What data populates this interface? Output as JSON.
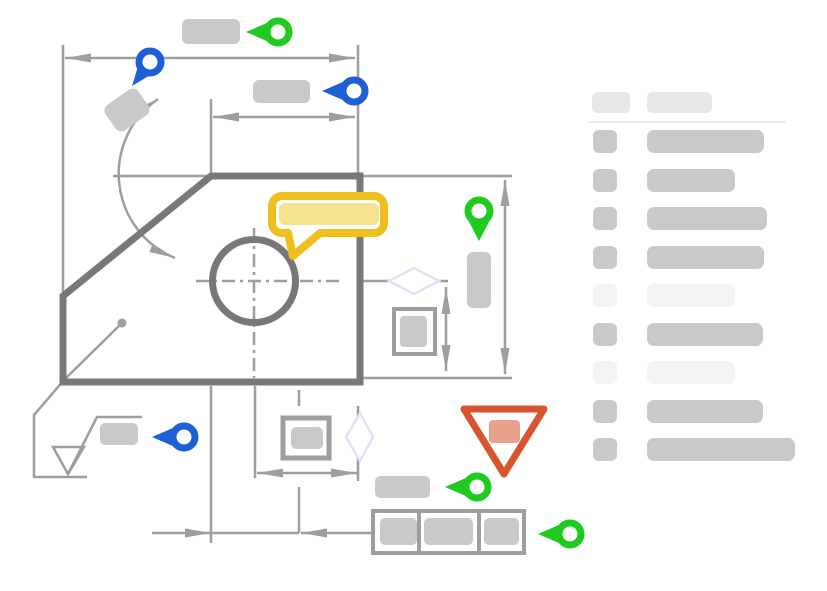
{
  "canvas": {
    "width": 827,
    "height": 591,
    "background": "#FFFFFF"
  },
  "colors": {
    "accent_green": "#1FCB1F",
    "accent_blue": "#1E5FD6",
    "comment_yellow": "#EFBF1D",
    "comment_yellow_fill": "#F5E28F",
    "warning_red": "#D6552F",
    "warning_red_fill": "#EAA28F",
    "outline_dark": "#787878",
    "line_gray": "#9E9E9E",
    "snap_diamond": "#DBE5F8",
    "placeholder_gray": "#C9C9C9",
    "placeholder_faint": "#F3F3F3",
    "placeholder_header": "#E8E8E8",
    "divider": "#ECECEC"
  },
  "drawing": {
    "annotations": [
      {
        "name": "top-overall-dimension",
        "marker": "green-pin-left",
        "label": "placeholder-bar"
      },
      {
        "name": "top-left-dimension",
        "marker": "blue-pin-tilted",
        "label": "placeholder-square-rotated"
      },
      {
        "name": "top-partial-dimension",
        "marker": "blue-pin-left",
        "label": "placeholder-bar"
      },
      {
        "name": "angle-dimension-arc",
        "marker": null,
        "label": null
      },
      {
        "name": "right-height-dimension",
        "marker": "green-map-pin",
        "label": "placeholder-bar-vertical"
      },
      {
        "name": "comment-bubble",
        "marker": "yellow-speech-bubble",
        "label": "placeholder-bar"
      },
      {
        "name": "surface-finish-callout",
        "marker": "blue-pin-left",
        "label": "placeholder-bar"
      },
      {
        "name": "warning-marker",
        "marker": "red-inverted-triangle",
        "label": "placeholder-square"
      },
      {
        "name": "tolerance-label",
        "marker": "green-pin-left",
        "label": "placeholder-bar"
      },
      {
        "name": "feature-control-frame",
        "marker": "green-pin-left",
        "cells": 3
      }
    ]
  },
  "sidebar": {
    "header": {
      "badge_w": 38,
      "title_w": 65
    },
    "rows": [
      {
        "tone": "normal",
        "bar_w": 117
      },
      {
        "tone": "normal",
        "bar_w": 88
      },
      {
        "tone": "normal",
        "bar_w": 120
      },
      {
        "tone": "normal",
        "bar_w": 117
      },
      {
        "tone": "faint",
        "bar_w": 88
      },
      {
        "tone": "normal",
        "bar_w": 116
      },
      {
        "tone": "faint",
        "bar_w": 88
      },
      {
        "tone": "normal",
        "bar_w": 116
      },
      {
        "tone": "normal",
        "bar_w": 148
      }
    ]
  }
}
